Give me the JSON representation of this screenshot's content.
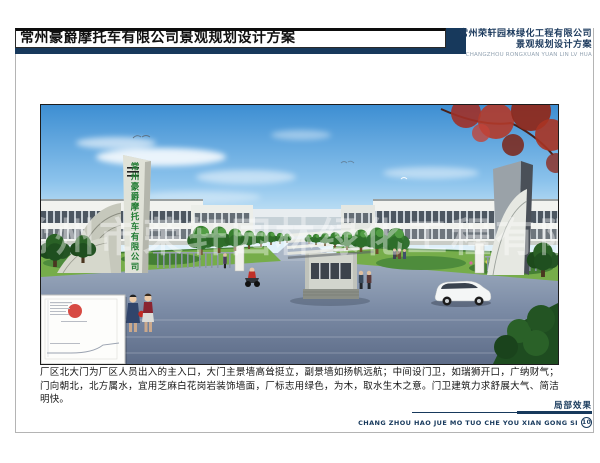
{
  "header": {
    "title": "常州豪爵摩托车有限公司景观规划设计方案",
    "company_name": "常州荣轩园林绿化工程有限公司",
    "company_subtitle": "景观规划设计方案",
    "company_pinyin": "CHANGZHOU RONGXUAN YUAN LIN LV HUA"
  },
  "rendering": {
    "gate_text_vertical": "常州豪爵摩托车有限公司",
    "watermark": "常州市荣轩园林绿化工程有限公司"
  },
  "description": "厂区北大门为厂区人员出入的主入口，大门主景墙高耸挺立，副景墙如扬帆远航；中间设门卫，如瑞狮开口，广纳财气；门向朝北，北方属水，宜用芝麻白花岗岩装饰墙面，厂标志用绿色，为木，取水生木之意。门卫建筑力求舒展大气、简洁明快。",
  "footer": {
    "caption": "局部效果",
    "pinyin": "CHANG ZHOU HAO JUE MO TUO CHE YOU XIAN GONG SI",
    "page_number": "10"
  },
  "colors": {
    "accent_navy": "#17395c",
    "gate_text_green": "#1e7a30",
    "stamp_red": "#d02a22"
  }
}
